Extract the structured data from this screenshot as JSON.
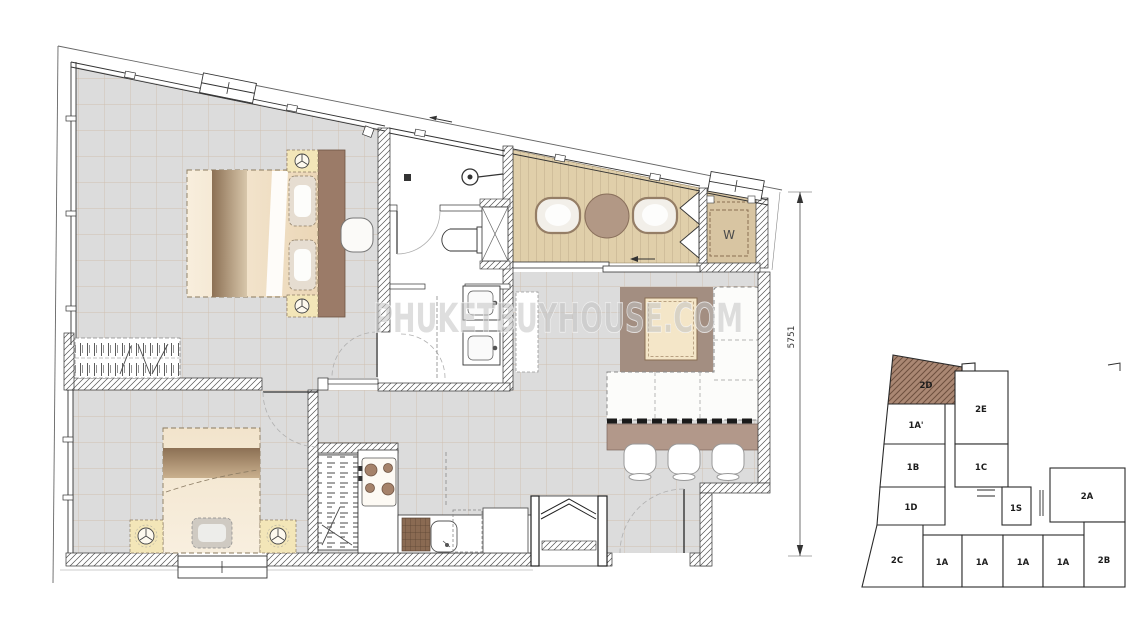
{
  "watermark": {
    "text": "PHUKETBUYHOUSE.COM"
  },
  "plan": {
    "dimension_right": "5751",
    "washer_label": "W"
  },
  "key_plan": {
    "highlighted_unit": "2D",
    "highlight_color": "#aa8773",
    "units": [
      {
        "id": "2D",
        "label": "2D",
        "highlighted": true
      },
      {
        "id": "1A-prime",
        "label": "1A'",
        "highlighted": false
      },
      {
        "id": "2E",
        "label": "2E",
        "highlighted": false
      },
      {
        "id": "1B",
        "label": "1B",
        "highlighted": false
      },
      {
        "id": "1C",
        "label": "1C",
        "highlighted": false
      },
      {
        "id": "1D",
        "label": "1D",
        "highlighted": false
      },
      {
        "id": "1S",
        "label": "1S",
        "highlighted": false
      },
      {
        "id": "2A",
        "label": "2A",
        "highlighted": false
      },
      {
        "id": "2C",
        "label": "2C",
        "highlighted": false
      },
      {
        "id": "1A-1",
        "label": "1A",
        "highlighted": false
      },
      {
        "id": "1A-2",
        "label": "1A",
        "highlighted": false
      },
      {
        "id": "1A-3",
        "label": "1A",
        "highlighted": false
      },
      {
        "id": "1A-4",
        "label": "1A",
        "highlighted": false
      },
      {
        "id": "2B",
        "label": "2B",
        "highlighted": false
      }
    ]
  },
  "colors": {
    "floor_tile": "#dcdcdc",
    "tile_grid": "#c6a78b",
    "deck": "#e0cfaa",
    "rug": "#a38e81",
    "counter": "#b2988a",
    "headboard": "#9b7b68",
    "bed": "#f2e4cc",
    "nightstand": "#f3e6b8",
    "watermark_gray": "#c2c2c2"
  }
}
